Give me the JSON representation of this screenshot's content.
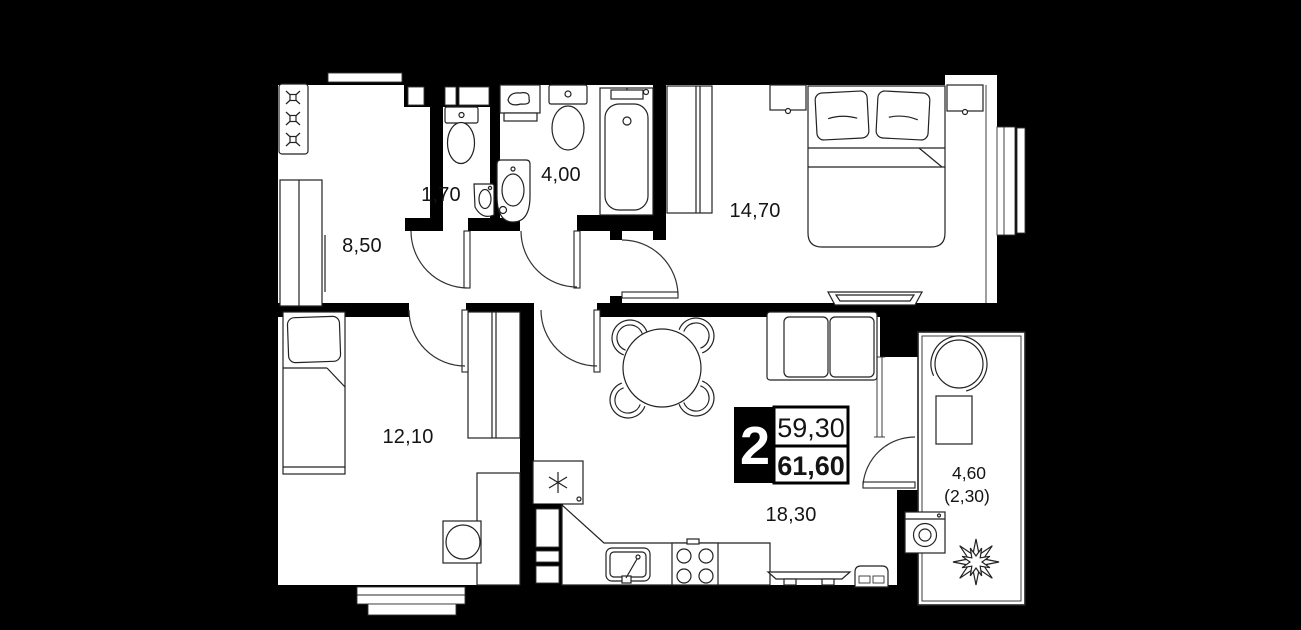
{
  "floor_plan": {
    "summary_badge": {
      "room_count": "2",
      "area_top": "59,30",
      "area_bottom": "61,60"
    },
    "rooms": {
      "hallway_area": "8,50",
      "wc_area": "1,70",
      "bathroom_area": "4,00",
      "bedroom_area": "14,70",
      "second_room_area": "12,10",
      "kitchen_living_area": "18,30",
      "balcony_area": "4,60",
      "balcony_area_reduced": "(2,30)"
    },
    "colors": {
      "background": "#000000",
      "floor": "#ffffff",
      "line": "#222222"
    }
  }
}
